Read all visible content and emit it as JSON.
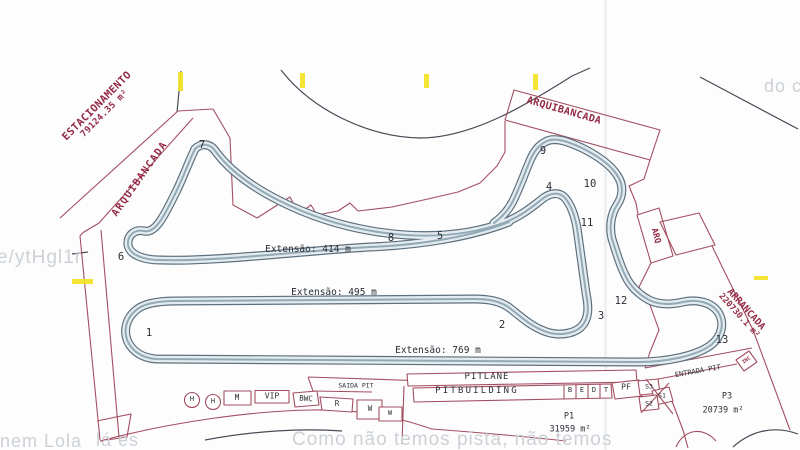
{
  "colors": {
    "track_edge": "#5d707e",
    "track_fill": "#e4ecf0",
    "boundary_red": "#a34e60",
    "label_red": "#942a46",
    "ink_black": "#2c2f35",
    "highlight_yellow": "#f3e32a",
    "watermark_gray": "#ccd1d6"
  },
  "zones": {
    "estacionamento": {
      "name": "ESTACIONAMENTO",
      "area": "79124.35 m²"
    },
    "arquibancada_left": {
      "name": "ARQUIBANCADA"
    },
    "arquibancada_top": {
      "name": "ARQUIBANCADA"
    },
    "arq": {
      "name": "ARQ"
    },
    "arrancada": {
      "name": "ARRANCADA",
      "area": "220730.1 m²"
    },
    "p1": {
      "name": "P1",
      "area": "31959 m²"
    },
    "p3": {
      "name": "P3",
      "area": "20739 m²"
    },
    "inc": {
      "name": "INC"
    }
  },
  "track": {
    "extensions": [
      "Extensão: 414 m",
      "Extensão: 495 m",
      "Extensão: 769 m"
    ],
    "corners": [
      "1",
      "2",
      "3",
      "4",
      "5",
      "6",
      "7",
      "8",
      "9",
      "10",
      "11",
      "12",
      "13"
    ]
  },
  "pit": {
    "pitlane": "PITLANE",
    "pitbuilding": "PITBUILDING",
    "cells": [
      "B",
      "E",
      "D",
      "T"
    ],
    "pf": "PF",
    "s1": "S1",
    "s2": "S2",
    "s3": "S3",
    "saida": "SAIDA PIT",
    "entrada": "ENTRADA PIT"
  },
  "facilities": [
    "H",
    "H",
    "M",
    "VIP",
    "BWC",
    "R",
    "W",
    "W"
  ],
  "watermarks": {
    "left": "e/ytHgl1r",
    "top_right": "do c",
    "bottom_left": "nem Lola",
    "bottom_left2": "lá es",
    "bottom": "Como não temos pista, não temos"
  }
}
